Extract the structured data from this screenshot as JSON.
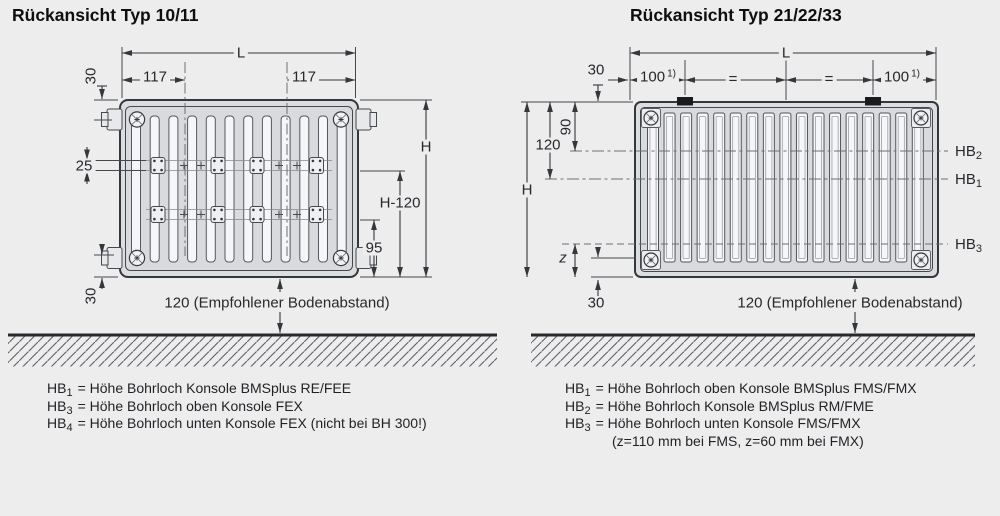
{
  "colors": {
    "background": "#ededee",
    "line": "#34373c",
    "clip_black": "#1a1b1d",
    "fin_fill": "#f6f6f8"
  },
  "left": {
    "title": "Rückansicht Typ 10/11",
    "dims": {
      "L": "L",
      "w117": "117",
      "t30": "30",
      "s25": "25",
      "H": "H",
      "H120": "H-120",
      "b95": "95",
      "b30": "30"
    },
    "floor_label": "120 (Empfohlener Bodenabstand)",
    "legend": [
      {
        "label": "HB",
        "sub": "1",
        "rest": "= Höhe Bohrloch Konsole BMSplus RE/FEE"
      },
      {
        "label": "HB",
        "sub": "3",
        "rest": "= Höhe Bohrloch oben Konsole FEX"
      },
      {
        "label": "HB",
        "sub": "4",
        "rest": "= Höhe Bohrloch unten Konsole FEX (nicht bei BH 300!)"
      }
    ]
  },
  "right": {
    "title": "Rückansicht Typ 21/22/33",
    "dims": {
      "L": "L",
      "t30": "30",
      "n100": "100",
      "sup1": "1)",
      "eq": "=",
      "r90": "90",
      "n120": "120",
      "H": "H",
      "z": "z",
      "b30": "30"
    },
    "hb": [
      {
        "label": "HB",
        "sub": "2"
      },
      {
        "label": "HB",
        "sub": "1"
      },
      {
        "label": "HB",
        "sub": "3"
      }
    ],
    "floor_label": "120 (Empfohlener Bodenabstand)",
    "legend": [
      {
        "label": "HB",
        "sub": "1",
        "rest": "= Höhe Bohrloch oben Konsole BMSplus FMS/FMX"
      },
      {
        "label": "HB",
        "sub": "2",
        "rest": "= Höhe Bohrloch Konsole BMSplus RM/FME"
      },
      {
        "label": "HB",
        "sub": "3",
        "rest": "= Höhe Bohrloch unten Konsole FMS/FMX"
      }
    ],
    "legend_note": "(z=110 mm bei FMS, z=60 mm bei FMX)"
  }
}
